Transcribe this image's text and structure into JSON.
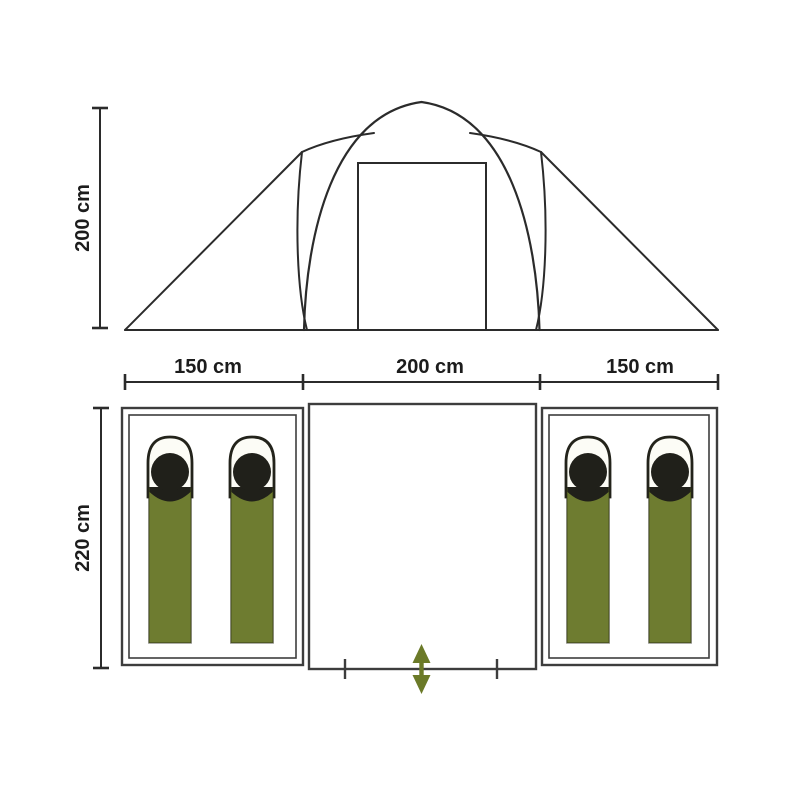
{
  "diagram": {
    "type": "tent-dimensions-diagram",
    "units": "cm",
    "side_view": {
      "name": "tent side elevation",
      "height_dimension": {
        "label": "200 cm",
        "value": 200
      },
      "features": [
        "dome-arch",
        "door-opening",
        "side-slopes",
        "ground-line"
      ]
    },
    "floor_plan": {
      "name": "tent floor plan",
      "depth_dimension": {
        "label": "220 cm",
        "value": 220
      },
      "width_dimensions": [
        {
          "label": "150 cm",
          "value": 150,
          "section": "left-bedroom"
        },
        {
          "label": "200 cm",
          "value": 200,
          "section": "center-vestibule"
        },
        {
          "label": "150 cm",
          "value": 150,
          "section": "right-bedroom"
        }
      ],
      "compartments": [
        {
          "name": "left-bedroom",
          "sleeping_bags": 2
        },
        {
          "name": "center-vestibule",
          "sleeping_bags": 0,
          "has_entrance": true
        },
        {
          "name": "right-bedroom",
          "sleeping_bags": 2
        }
      ],
      "entrance": {
        "marker": "double-headed-arrow",
        "direction": "in-out"
      }
    },
    "colors": {
      "line": "#2b2b2b",
      "plan_line": "#3d3d3d",
      "bag_green": "#6e7c30",
      "bag_dark": "#20201a",
      "hood_fill": "#fcfcf6",
      "arrow_green": "#6b7a28",
      "text": "#1c1c1c",
      "background": "#ffffff"
    }
  }
}
